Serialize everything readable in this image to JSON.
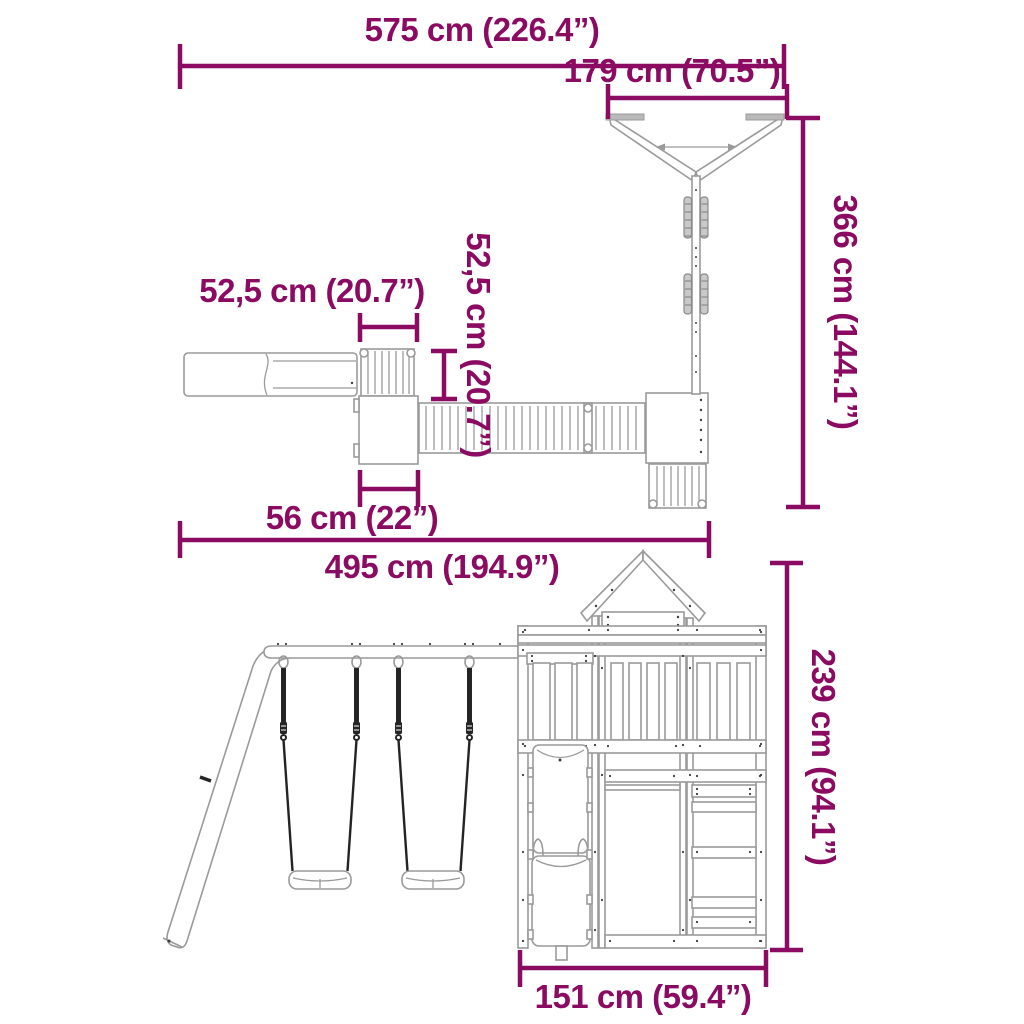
{
  "image": {
    "kind": "product-dimension-diagram",
    "subject": "wooden playset with swing set, slide and play tower",
    "background": "#ffffff"
  },
  "colors": {
    "dimension_accent": "#8B0B62",
    "line_art": "#9a9a9a",
    "rope_dark": "#242424",
    "metal_gray": "#b9b9b9"
  },
  "plan": {
    "dims": {
      "overall_width": {
        "label": "575 cm (226.4”)"
      },
      "swing_frame_width": {
        "label": "179 cm (70.5”)"
      },
      "swing_frame_depth": {
        "label": "366 cm (144.1”)"
      },
      "climber_width": {
        "label": "52,5 cm (20.7”)"
      },
      "walkway_width": {
        "label": "52,5 cm (20.7”)"
      },
      "platform_width": {
        "label": "56 cm (22”)"
      },
      "play_structure_span": {
        "label": "495 cm (194.9”)"
      }
    }
  },
  "front": {
    "dims": {
      "tower_height": {
        "label": "239 cm (94.1”)"
      },
      "tower_width": {
        "label": "151 cm (59.4”)"
      }
    }
  }
}
